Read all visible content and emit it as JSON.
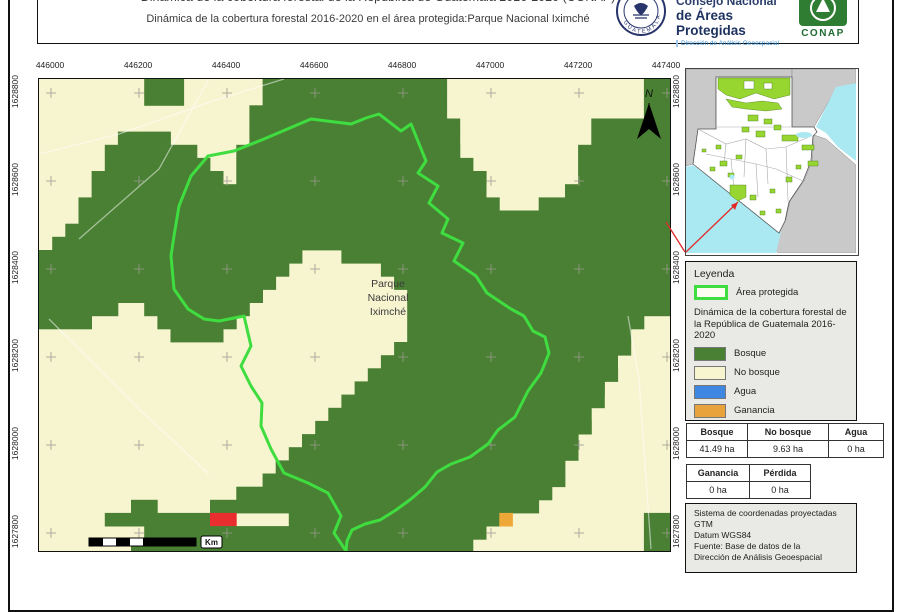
{
  "header": {
    "clipped_title": "Dinámica de la cobertura forestal de la República de Guatemala 2016-2020 (CONAP)",
    "subtitle": "Dinámica de la cobertura forestal 2016-2020 en el área protegida:Parque Nacional Iximché",
    "org": {
      "line1": "Consejo Nacional",
      "line2": "de Áreas Protegidas",
      "line3": "Dirección de Análisis Geoespacial",
      "seal_text": "GUATEMALA",
      "conap_label": "CONAP"
    }
  },
  "map": {
    "label": {
      "line1": "Parque",
      "line2": "Nacional",
      "line3": "Iximché"
    },
    "north_label": "N",
    "scale_unit": "Km",
    "x_labels": [
      "446000",
      "446200",
      "446400",
      "446600",
      "446800",
      "447000",
      "447200",
      "447400"
    ],
    "y_labels": [
      "1628800",
      "1628600",
      "1628400",
      "1628200",
      "1628000",
      "1627800"
    ],
    "grid_cross_xs": [
      12,
      100,
      188,
      276,
      364,
      452,
      540,
      628
    ],
    "grid_cross_ys": [
      14,
      102,
      190,
      278,
      366,
      454
    ],
    "cell": {
      "w": 13.15,
      "h": 13.15
    },
    "palette": {
      ".": "#f7f4d0",
      "G": "#4a8034",
      "R": "#e82e2e",
      "O": "#eda838"
    },
    "raster_rows": [
      "........GGG......GGGGGGGGGGGGGG...............GG",
      "........GGG......GGGGGGGGGGGGGG...............GG",
      "................GGGGGGGGGGGGGGG...............GG",
      "................GGGGGGGGGGGGGGGG..........GGGGGG",
      "......GGGG......GGGGGGGGGGGGGGGG..........GGGGGG",
      ".....GGGGGGG...GGGGGGGGGGGGGGGGG.........GGGGGGG",
      ".....GGGGGGGG..GGGGGGGGGGGGGGGGGG........GGGGGGG",
      "....GGGGGGGGGG.GGGGGGGGGGGGGGGGGGG.......GGGGGGG",
      "....GGGGGGGGGGGGGGGGGGGGGGGGGGGGGG......GGGGGGGG",
      "...GGGGGGGGGGGGGGGGGGGGGGGGGGGGGGGG...GGGGGGGGGG",
      "...GGGGGGGGGGGGGGGGGGGGGGGGGGGGGGGGGGGGGGGGGGGGG",
      "..GGGGGGGGGGGGGGGGGGGGGGGGGGGGGGGGGGGGGGGGGGGGGG",
      ".GGGGGGGGGGGGGGGGGGGGGGGGGGGGGGGGGGGGGGGGGGGGGGG",
      "GGGGGGGGGGGGGGGGGGGG...GGGGGGGGGGGGGGGGGGGGGGGGG",
      "GGGGGGGGGGGGGGGGGGG.......GGGGGGGGGGGGGGGGGGGGGG",
      "GGGGGGGGGGGGGGGGGG.........GGGGGGGGGGGGGGGGGGGGG",
      "GGGGGGGGGGGGGGGGG...........GGGGGGGGGGGGGGGGGGGG",
      "GGGGGG..GGGGGGGG............GGGGGGGGGGGGGGGGGGGG",
      "GGGG.....GGGGGG.............GGGGGGGGGGGGGGGGGG..",
      "..........GGGG..............GGGGGGGGGGGGGGGGG...",
      "...........................GGGGGGGGGGGGGGGGGG...",
      "..........................GGGGGGGGGGGGGGGGGG....",
      ".........................GGGGGGGGGGGGGGGGGGG....",
      "........................GGGGGGGGGGGGGGGGGGG.....",
      ".......................GGGGGGGGGGGGGGGGGGGG.....",
      "......................GGGGGGGGGGGGGGGGGGGG......",
      ".....................GGGGGGGGGGGGGGGGGGGGG......",
      "....................GGGGGGGGGGGGGGGGGGGGG.......",
      "...................GGGGGGGGGGGGGGGGGGGGGG.......",
      "..................GGGGGGGGGGGGGGGGGGGGGG........",
      ".................GGGGGGGGGGGGGGGGGGGGGGG........",
      "...............GGGGGGGGGGGGGGGGGGGGGGGG.........",
      ".......GG....GGGGGGGGGGGGGGGGGGGGGGGGG..........",
      ".....GGGGGGGGRR....GGGGGGGGGGGGGGGGO..........GG",
      "........GGGGGGGGGGGGGGGGGGGGGGGGGG............GG",
      ".......GGGGGGGGGGGGGGGGGGGGGGGGGG.............GG"
    ],
    "outline_color": "#3fdd3f",
    "outline_points": "307,472 295,454 302,437 289,414 269,404 245,394 232,370 222,347 223,324 212,307 202,287 212,267 205,237 180,242 165,240 149,230 135,210 132,177 135,157 140,127 152,97 169,77 195,72 225,60 272,40 312,45 327,39 340,35 362,52 372,45 387,82 379,94 399,107 390,124 409,140 403,154 424,164 415,182 437,197 448,214 472,230 485,237 494,252 506,258 510,274 502,294 489,312 476,338 459,351 449,365 431,378 412,385 398,393 386,408 372,420 357,431 341,441 326,445 313,451 308,462"
  },
  "inset": {
    "colors": {
      "country": "#ffffff",
      "neighbors": "#c9c9c9",
      "water": "#aae9f2",
      "protected": "#97d630",
      "leader": "#e02a2a"
    }
  },
  "legend": {
    "title": "Leyenda",
    "area_item": {
      "label": "Área protegida",
      "outline": "#3fdd3f"
    },
    "subtitle": "Dinámica de la cobertura forestal de la República de Guatemala 2016-2020",
    "items": [
      {
        "label": "Bosque",
        "color": "#4a8034"
      },
      {
        "label": "No bosque",
        "color": "#f7f4d0"
      },
      {
        "label": "Agua",
        "color": "#3f87e0"
      },
      {
        "label": "Ganancia",
        "color": "#e8a33c"
      },
      {
        "label": "Pérdida",
        "color": "#e02a2a"
      }
    ]
  },
  "tables": {
    "coverage": {
      "headers": [
        "Bosque",
        "No bosque",
        "Agua"
      ],
      "values": [
        "41.49 ha",
        "9.63 ha",
        "0 ha"
      ]
    },
    "change": {
      "headers": [
        "Ganancia",
        "Pérdida"
      ],
      "values": [
        "0 ha",
        "0 ha"
      ]
    }
  },
  "info_box": {
    "lines": [
      "Sistema de coordenadas proyectadas",
      "GTM",
      "Datum WGS84",
      "Fuente: Base de datos de la",
      "Dirección de Análisis Geoespacial"
    ]
  }
}
